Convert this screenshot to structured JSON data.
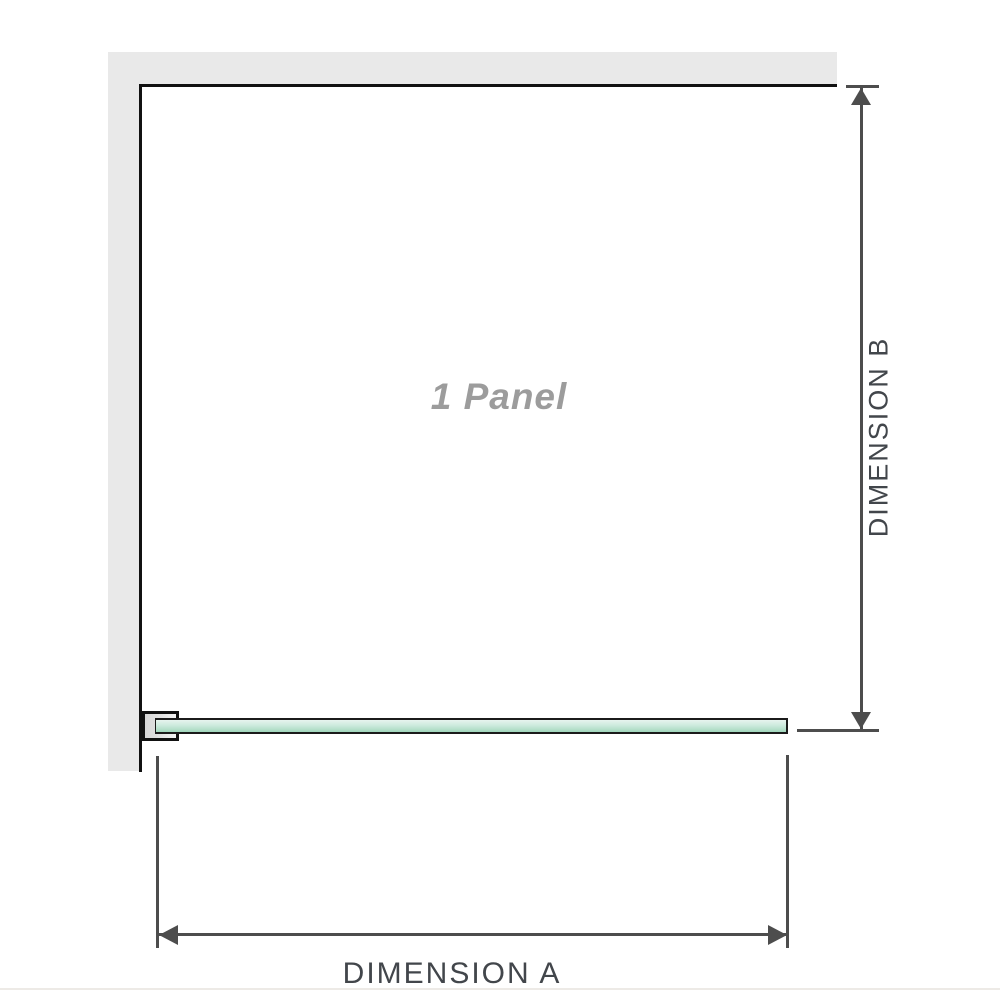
{
  "diagram": {
    "panel_label": "1 Panel",
    "dimension_a": {
      "label": "DIMENSION A"
    },
    "dimension_b": {
      "label": "DIMENSION B"
    },
    "colors": {
      "wall_fill": "#e9e9e9",
      "panel_outline": "#111111",
      "dimension_line": "#4d4d4d",
      "dimension_label_text": "#42464b",
      "panel_label_text": "#9c9c9c",
      "glass_green_light": "#e8f4ee",
      "glass_green_dark": "#9fd6bb",
      "bracket_fill": "#e2e2e2",
      "divider": "#edeae6"
    }
  }
}
